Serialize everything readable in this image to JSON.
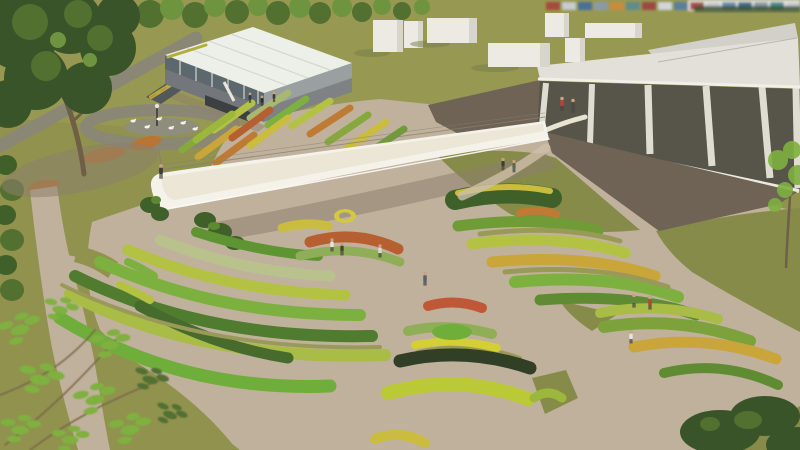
{
  "palette": {
    "grass": "#90924e",
    "grass_light": "#9d9f56",
    "grass_dark": "#878b49",
    "grass_strip": "#9a9a58",
    "tree_dark": "#3a5429",
    "tree_mid": "#527030",
    "tree_light": "#6f9440",
    "leaf_bright": "#7fb040",
    "trunk": "#6e5f46",
    "path_gray": "#8a8775",
    "plaza": "#c0b19d",
    "plaza_light": "#cdbfa9",
    "shadow": "#8d7f6b",
    "bridge": "#f4f2e9",
    "bridge_top": "#e9e4d2",
    "bridge_edge": "#fdfcf8",
    "cable": "#87816f",
    "roof": "#e2e0d8",
    "roof_back": "#d2d0c8",
    "fascia": "#f0efe8",
    "glass": "#57544a",
    "column": "#dfdcd2",
    "plinth": "#eceade",
    "terrace": "#6e6354",
    "gh_roof": "#edefe9",
    "gh_glass": "#5c686e",
    "gh_wall": "#9aa0a2",
    "gh_wall_dark": "#7e8284",
    "gh_module": "#73767a",
    "gh_dark": "#3c4043",
    "ramp": "#53585b",
    "planter_green": "#b2ae3a",
    "planter_orange": "#c98c3a",
    "box": "#eceae2",
    "box_side": "#d8d5ca",
    "box_shadow": "#767b46",
    "pond": "#8f8d7c",
    "goose": "#f4f2ea",
    "lamp": "#3c3c38",
    "lamp_head": "#e8e4d4",
    "hedge": "#3f6029",
    "hedge_light": "#5c8a33",
    "orange_flowers": "#c0722e",
    "treeline": "#3a5030",
    "bg_white": "#e8e9e6"
  },
  "containers": [
    "#a84a3e",
    "#c8ccd0",
    "#4a6f9c",
    "#8c9aa6",
    "#c98c3a",
    "#5f8c8c",
    "#9c4a42",
    "#d2d6da",
    "#5a7ea0",
    "#a85048",
    "#c8ccd0",
    "#6b8caa",
    "#3f6e8e",
    "#8c9aa6",
    "#4a8c8c",
    "#c8ccd0"
  ],
  "beds": {
    "A": [
      "#a9b871",
      "#b4c244",
      "#bf7a33",
      "#86a83c",
      "#c9bc3e",
      "#6f9c36",
      "#86a83c",
      "#c9a53a",
      "#bf7a33",
      "#7db13f",
      "#b4c244",
      "#b65f31",
      "#c9bc3e",
      "#9cb83c"
    ],
    "B": [
      "#5f9433",
      "#b9c28c",
      "#b4c244",
      "#7db13f",
      "#4f7c2e",
      "#a8bc46",
      "#6fae3a",
      "#466b2c"
    ],
    "FL": [
      "#7db13f",
      "#b4c244"
    ],
    "M": [
      "#c9bc3e",
      "#d3c93f",
      "#b65f31",
      "#8fae57"
    ],
    "C": [
      "#3f6029",
      "#c9bc3e",
      "#6f9c36",
      "#b4c244",
      "#c9a53a",
      "#7db13f",
      "#5f8c33",
      "#bf7a33"
    ],
    "D": [
      "#c05838",
      "#8fae57",
      "#d4cf35",
      "#303f26",
      "#bcc937",
      "#c9bc3e",
      "#6fae3a"
    ],
    "E": [
      "#9cb83c",
      "#a8bc46",
      "#7da23c",
      "#c9a53a",
      "#5f8c33"
    ]
  },
  "people": [
    {
      "style": "color:#b2453a"
    },
    {
      "style": "color:#4a4a48"
    },
    {
      "style": "color:#3e3e3c"
    },
    {
      "style": "color:#5c6b4a"
    },
    {
      "style": "color:#3c3c3a"
    },
    {
      "style": "color:#e8e4da"
    },
    {
      "style": "color:#4a4438"
    },
    {
      "style": "color:#ddd8cc"
    },
    {
      "style": "color:#5a6470"
    },
    {
      "style": "color:#5c8a3c"
    },
    {
      "style": "color:#b2453a"
    },
    {
      "style": "color:#e8e4da"
    },
    {
      "style": "color:#3a3a38"
    },
    {
      "style": "color:#2e2e2c"
    },
    {
      "style": "color:#3a3a38"
    }
  ]
}
